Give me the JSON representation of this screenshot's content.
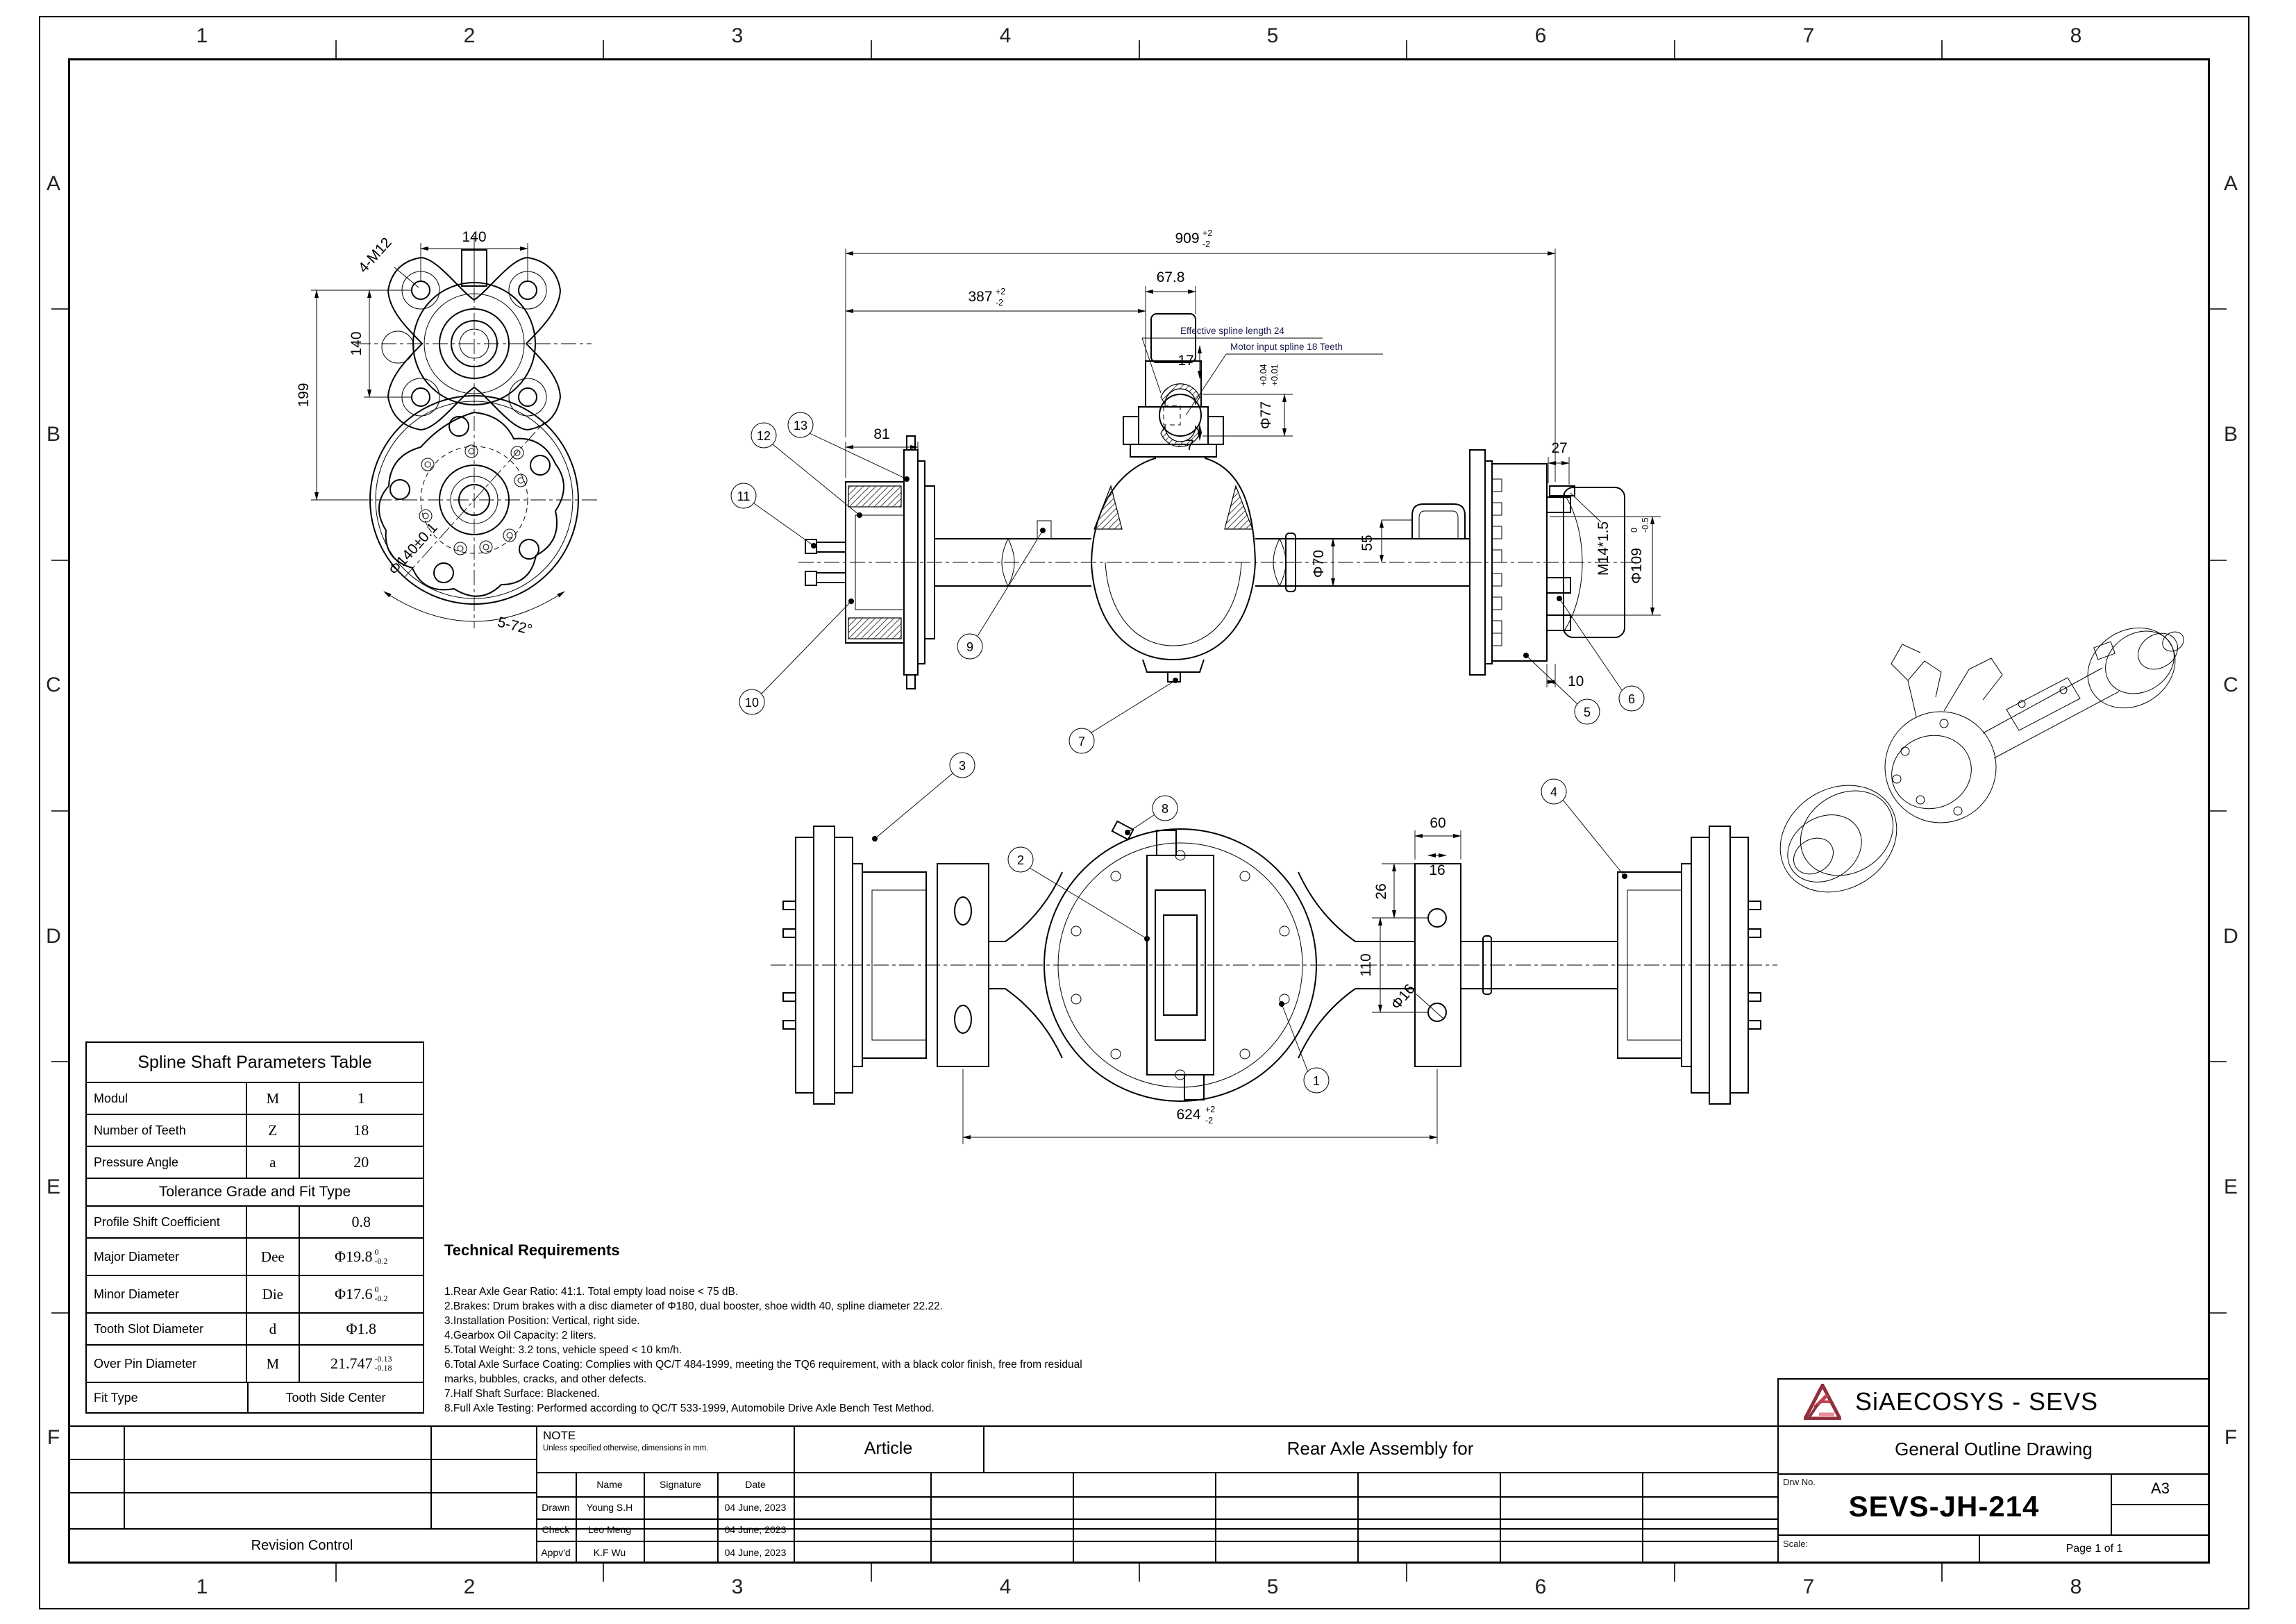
{
  "colors": {
    "line": "#000000",
    "note_blue": "#1c1c4f",
    "logo_red": "#c2404e",
    "logo_dark": "#8f2f3c",
    "logo_pink": "#e98898"
  },
  "sheet": {
    "cols": [
      "1",
      "2",
      "3",
      "4",
      "5",
      "6",
      "7",
      "8"
    ],
    "rows": [
      "A",
      "B",
      "C",
      "D",
      "E",
      "F"
    ]
  },
  "spline_table": {
    "title": "Spline Shaft Parameters Table",
    "modul": {
      "label": "Modul",
      "sym": "M",
      "val": "1"
    },
    "teeth": {
      "label": "Number of Teeth",
      "sym": "Z",
      "val": "18"
    },
    "pressure": {
      "label": "Pressure Angle",
      "sym": "a",
      "val": "20"
    },
    "tol_header": "Tolerance Grade and Fit Type",
    "shift": {
      "label": "Profile Shift Coefficient",
      "sym": "",
      "val": "0.8"
    },
    "major": {
      "label": "Major Diameter",
      "sym": "Dee",
      "val": "Φ19.8",
      "tu": "0",
      "tl": "-0.2"
    },
    "minor": {
      "label": "Minor Diameter",
      "sym": "Die",
      "val": "Φ17.6",
      "tu": "0",
      "tl": "-0.2"
    },
    "slot": {
      "label": "Tooth Slot Diameter",
      "sym": "d",
      "val": "Φ1.8"
    },
    "overpin": {
      "label": "Over Pin Diameter",
      "sym": "M",
      "val": "21.747",
      "tu": "-0.13",
      "tl": "-0.18"
    },
    "fit": {
      "label": "Fit Type",
      "val": "Tooth Side Center"
    }
  },
  "tech_req": {
    "title": "Technical Requirements",
    "items": [
      "1.Rear Axle Gear Ratio: 41:1. Total empty load noise < 75 dB.",
      "2.Brakes: Drum brakes with a disc diameter of Φ180, dual booster, shoe width 40, spline diameter 22.22.",
      "3.Installation Position: Vertical, right side.",
      "4.Gearbox Oil Capacity: 2 liters.",
      "5.Total Weight: 3.2 tons, vehicle speed < 10 km/h.",
      "6.Total Axle Surface Coating: Complies with QC/T 484-1999, meeting the TQ6 requirement, with a black color finish, free from residual marks, bubbles, cracks, and other defects.",
      "7.Half Shaft Surface: Blackened.",
      "8.Full Axle Testing: Performed according to QC/T 533-1999, Automobile Drive Axle Bench Test Method."
    ]
  },
  "views": {
    "front": {
      "d_top": "140",
      "d_left": "140",
      "d_height": "199",
      "holes": "4-M12",
      "bolt_circle": "Φ140±0.1",
      "angle": "5-72°"
    },
    "side": {
      "overall": "909",
      "overall_tu": "+2",
      "overall_tl": "-2",
      "mid": "387",
      "mid_tu": "+2",
      "mid_tl": "-2",
      "motor_w": "67.8",
      "hub_w": "81",
      "d27": "27",
      "d55": "55",
      "tube": "Φ70",
      "d17": "17",
      "d7": "7",
      "spline_d": "Φ77",
      "spline_tu": "+0.04",
      "spline_tl": "+0.01",
      "thread": "M14*1.5",
      "drum_d": "Φ109",
      "drum_tu": "0",
      "drum_tl": "-0.5",
      "d10": "10",
      "note_len": "Effective spline length 24",
      "note_teeth": "Motor input spline 18 Teeth",
      "balloons": [
        "12",
        "13",
        "11",
        "10",
        "9",
        "7",
        "5",
        "6"
      ]
    },
    "plan": {
      "overall": "624",
      "tu": "+2",
      "tl": "-2",
      "d110": "110",
      "d26": "26",
      "d60": "60",
      "d16": "16",
      "hole": "Φ16",
      "balloons": [
        "3",
        "2",
        "8",
        "4",
        "1"
      ]
    }
  },
  "title_block": {
    "note_title": "NOTE",
    "note_text": "Unless specified otherwise, dimensions in mm.",
    "article_label": "Article",
    "article_value": "Rear Axle Assembly for",
    "revision_label": "Revision Control",
    "sign_headers": {
      "name": "Name",
      "signature": "Signature",
      "date": "Date"
    },
    "sign_rows": [
      {
        "role": "Drawn",
        "name": "Young S.H",
        "date": "04 June, 2023"
      },
      {
        "role": "Check",
        "name": "Leo Meng",
        "date": "04 June, 2023"
      },
      {
        "role": "Appv'd",
        "name": "K.F Wu",
        "date": "04 June, 2023"
      }
    ],
    "company": "SiAECOSYS - SEVS",
    "doc_title": "General Outline Drawing",
    "drw_no_label": "Drw No.",
    "drw_no": "SEVS-JH-214",
    "paper": "A3",
    "scale_label": "Scale:",
    "page": "Page 1 of 1"
  }
}
